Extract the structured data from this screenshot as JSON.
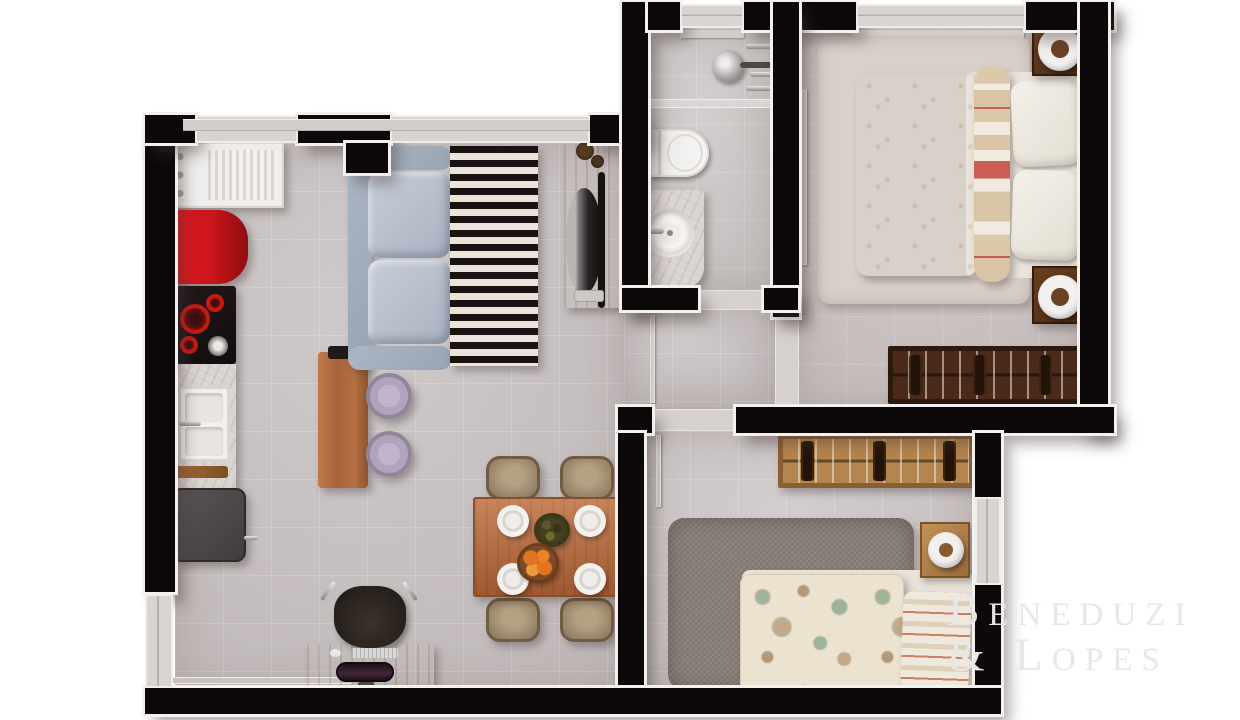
{
  "watermark": {
    "line1": "Beneduzi",
    "line2": "& Lopes"
  },
  "colors": {
    "wall": "#0d090a",
    "outline": "#f3f0ee",
    "floor": "#c9c2c2",
    "floor_bath": "#ccc8c7",
    "floor_master": "#cbc4c3",
    "floor_bed2": "#cdc6c6",
    "glass": "#d8d4d2",
    "sill": "#d3cecc",
    "threshold": "#d6d1cf",
    "leaf": "#d0cbca",
    "fridge": "#c9151b",
    "burner": "#c21b14",
    "rug_dark": "#191112",
    "rug_light": "#eae4db",
    "marble": "#dcd6d3",
    "lamp_ring": "#f2f0ee",
    "bed2_rug": "#8b8078",
    "paisley_base": "#ece2d0",
    "watermark": "#e9e7e5"
  },
  "rooms_note": "top-down apartment floor plan rendering"
}
